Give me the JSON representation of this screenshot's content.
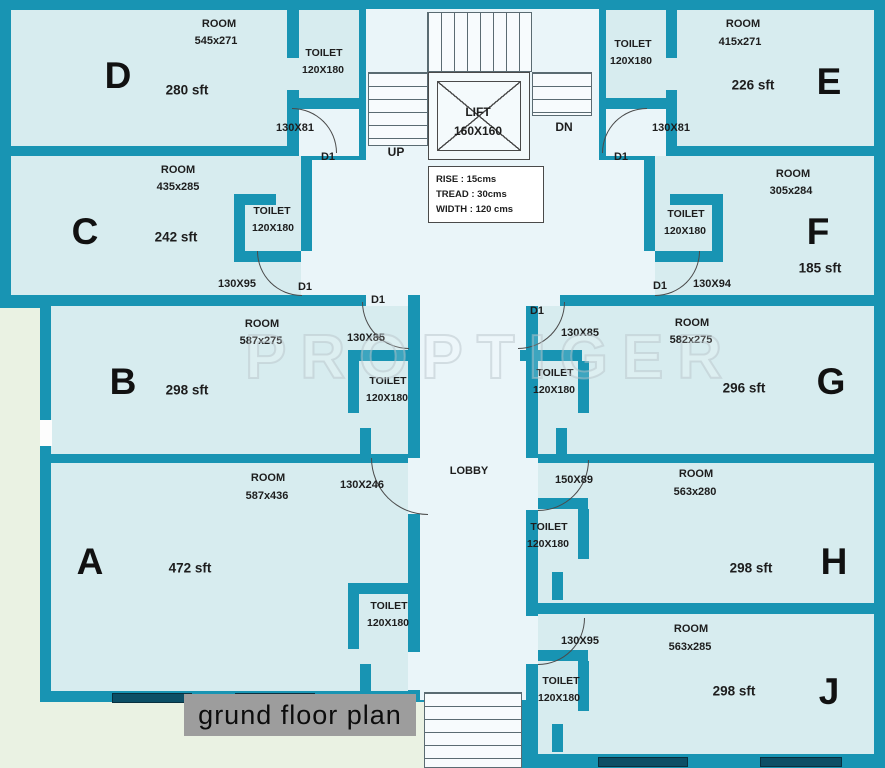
{
  "plan": {
    "title": "grund floor plan",
    "watermark": "PROPTIGER",
    "lobby_label": "LOBBY",
    "lift": {
      "label": "LIFT",
      "size": "160X160"
    },
    "stairs": {
      "up": "UP",
      "down": "DN"
    },
    "stair_note": {
      "rise": "RISE : 15cms",
      "tread": "TREAD : 30cms",
      "width": "WIDTH : 120 cms"
    },
    "door_tag": "D1",
    "toilet": {
      "label": "TOILET",
      "size": "120X180"
    },
    "rooms": {
      "A": {
        "letter": "A",
        "type": "ROOM",
        "dims": "587x436",
        "area": "472 sft"
      },
      "B": {
        "letter": "B",
        "type": "ROOM",
        "dims": "587x275",
        "area": "298 sft"
      },
      "C": {
        "letter": "C",
        "type": "ROOM",
        "dims": "435x285",
        "area": "242 sft"
      },
      "D": {
        "letter": "D",
        "type": "ROOM",
        "dims": "545x271",
        "area": "280 sft"
      },
      "E": {
        "letter": "E",
        "type": "ROOM",
        "dims": "415x271",
        "area": "226 sft"
      },
      "F": {
        "letter": "F",
        "type": "ROOM",
        "dims": "305x284",
        "area": "185 sft"
      },
      "G": {
        "letter": "G",
        "type": "ROOM",
        "dims": "582x275",
        "area": "296 sft"
      },
      "H": {
        "letter": "H",
        "type": "ROOM",
        "dims": "563x280",
        "area": "298 sft"
      },
      "J": {
        "letter": "J",
        "type": "ROOM",
        "dims": "563x285",
        "area": "298 sft"
      }
    },
    "openings": {
      "d_lift": "130X81",
      "e_lift": "130X81",
      "c_hall": "130X95",
      "f_hall": "130X94",
      "b_lobby": "130X85",
      "g_lobby": "130X85",
      "a_lobby": "130X246",
      "h_lobby": "150X89",
      "j_lobby": "130X95"
    },
    "colors": {
      "wall": "#1894b3",
      "room_fill": "#d7ecef",
      "hall_fill": "#eaf5f9",
      "outside": "#eaf2e3",
      "window": "#0c4f66",
      "title_bg": "#9d9d9d"
    }
  }
}
